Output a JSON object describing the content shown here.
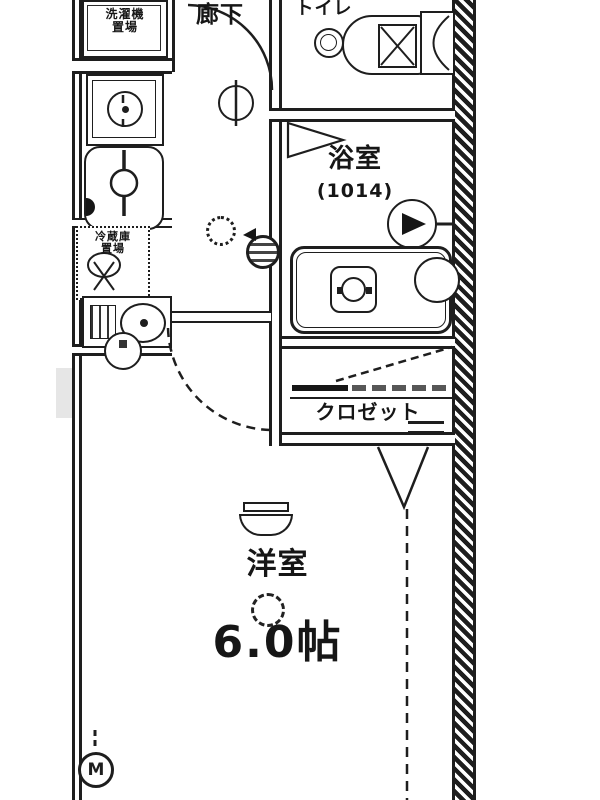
{
  "floorplan": {
    "labels": {
      "hallway": "廊下",
      "toilet": "トイレ",
      "bathroom": "浴室",
      "bathroom_size": "(1014)",
      "closet": "クロゼット",
      "room": "洋室",
      "room_size": "6.0帖",
      "washer_line1": "洗濯機",
      "washer_line2": "置場",
      "fridge_line1": "冷蔵庫",
      "fridge_line2": "置場",
      "meter": "M"
    },
    "colors": {
      "line": "#1e1e1e",
      "bg": "#ffffff",
      "watermark": "#d8d8d8"
    }
  }
}
